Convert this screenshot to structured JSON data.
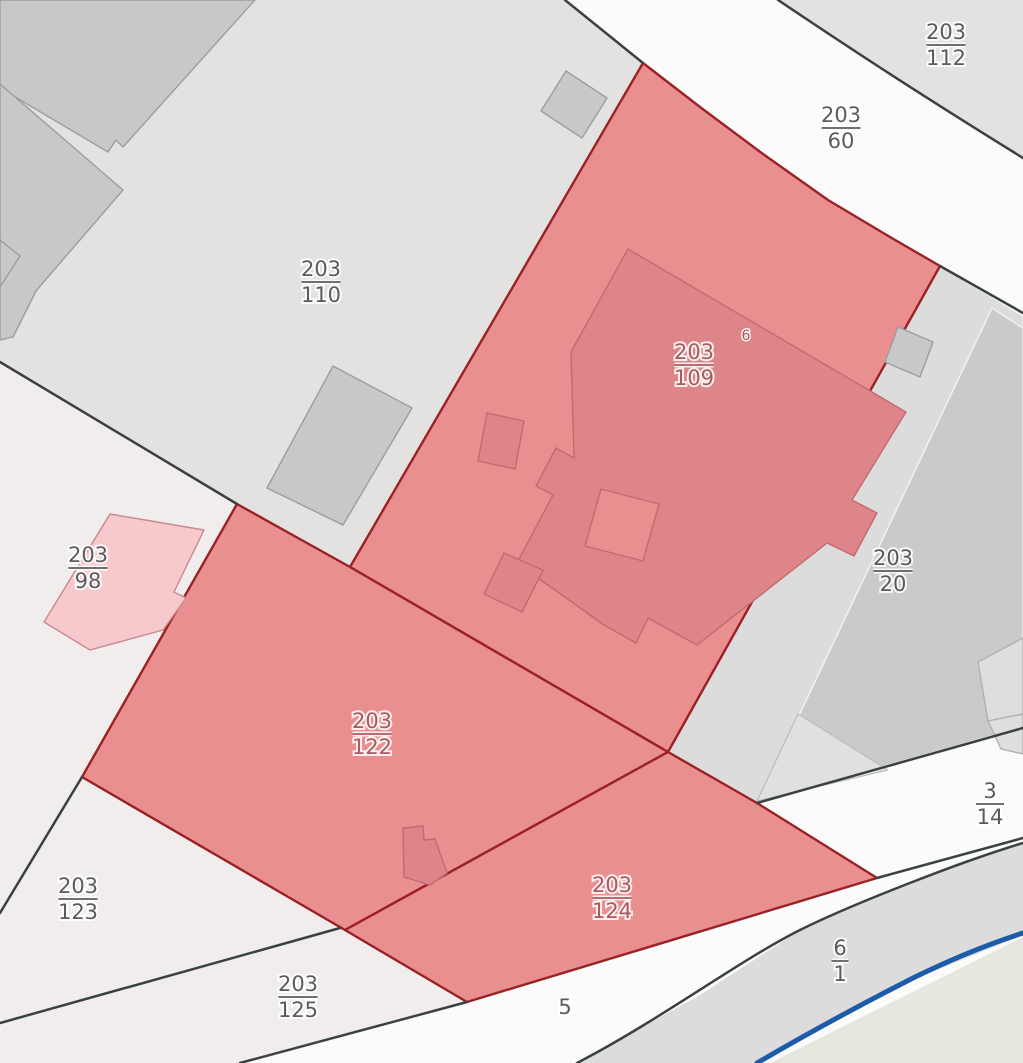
{
  "map": {
    "canvas": {
      "width": 1023,
      "height": 1063,
      "background": "#fbfbfb"
    },
    "palette": {
      "road_white": "#fbfbfb",
      "parcel_gray": "#e3e2e1",
      "parcel_pale": "#f1edec",
      "parcel_medium_gray": "#cacaca",
      "parcel_strip_gray": "#dddcdc",
      "parcel_back_gray": "#dcdcdc",
      "parcel_sage": "#e5e7de",
      "selection_red_fill": "#e98f8f",
      "selection_red_stroke": "#9b2126",
      "building_gray_fill": "#c8c8c8",
      "building_gray_stroke": "#9d9d9d",
      "building_red_fill": "#dd8588",
      "building_red_stroke": "#c26b6f",
      "building_pink_fill": "#f8c9cc",
      "building_pink_stroke": "#c9898e",
      "building_light_fill": "#dedede",
      "building_light_stroke": "#b0b0b0",
      "boundary_dark": "#3a4141",
      "stream_blue": "#1e5ca9",
      "label_gray": "#5b5b5b",
      "label_red": "#a85b60"
    },
    "regions": [
      {
        "id": "area-98",
        "points": "0,362 237,504 82,777 0,913",
        "fill": "#f1edec",
        "stroke": "none",
        "sw": 0,
        "interactable": true
      },
      {
        "id": "parcel-203-123",
        "points": "0,913 82,777 345,930 0,1023",
        "fill": "#f1edec",
        "stroke": "none",
        "sw": 0,
        "interactable": true
      },
      {
        "id": "parcel-203-125",
        "points": "0,1023 340,928 467,1002 240,1063 0,1063",
        "fill": "#f1edec",
        "stroke": "none",
        "sw": 0,
        "interactable": true
      },
      {
        "id": "parcel-203-110",
        "points": "0,0 565,0 643,63 350,567 237,504 0,362",
        "fill": "#e3e2e1",
        "stroke": "none",
        "sw": 0,
        "interactable": true
      },
      {
        "id": "parcel-203-112",
        "points": "778,0 1023,0 1023,158 940,106 845,45",
        "fill": "#e3e2e1",
        "stroke": "none",
        "sw": 0,
        "interactable": true
      },
      {
        "id": "road-shoulder-strip",
        "points": "940,266 1023,316 1023,342 770,799 757,803 668,752",
        "fill": "#dddcdc",
        "stroke": "#f4f4f4",
        "sw": 1.2,
        "interactable": false
      },
      {
        "id": "parcel-203-20",
        "points": "992,308 1023,328 1023,727 758,802",
        "fill": "#cacaca",
        "stroke": "#f1f1f1",
        "sw": 1.5,
        "interactable": true
      },
      {
        "id": "parcel-20-wedge",
        "points": "798,714 888,770 757,801",
        "fill": "#e0e0e0",
        "stroke": "#b7b7b7",
        "sw": 1,
        "interactable": false
      },
      {
        "id": "parcel-6-1",
        "points": "577,1063 700,995 800,930 877,895 960,862 1023,843 1023,935 900,985 800,1040 757,1063",
        "fill": "#dcdcdc",
        "stroke": "none",
        "sw": 0,
        "interactable": true
      },
      {
        "id": "area-sage",
        "points": "770,1063 1023,937 1023,1063",
        "fill": "#e5e7de",
        "stroke": "none",
        "sw": 0,
        "interactable": false
      },
      {
        "id": "parcel-203-109",
        "points": "643,63 700,107 763,154 828,200 890,237 940,266 668,752 350,567",
        "fill": "#e98f8f",
        "stroke": "#9b2126",
        "sw": 2.4,
        "interactable": true
      },
      {
        "id": "parcel-203-122",
        "points": "237,504 350,567 668,752 345,930 82,777",
        "fill": "#e98f8f",
        "stroke": "#9b2126",
        "sw": 2.4,
        "interactable": true
      },
      {
        "id": "parcel-203-124",
        "points": "668,752 757,803 877,878 467,1002 345,930",
        "fill": "#e98f8f",
        "stroke": "#9b2126",
        "sw": 2.4,
        "interactable": true
      }
    ],
    "buildings": [
      {
        "id": "building-gray-1",
        "points": "0,0 255,0 123,147 116,140 108,152 0,88",
        "kind": "gray"
      },
      {
        "id": "building-gray-2",
        "points": "0,84 123,190 48,277 36,291 13,337 0,340",
        "kind": "gray"
      },
      {
        "id": "building-gray-3",
        "points": "0,240 20,256 0,287",
        "kind": "gray"
      },
      {
        "id": "building-gray-4",
        "points": "333,366 412,408 343,525 267,488",
        "kind": "gray"
      },
      {
        "id": "building-gray-5",
        "points": "566,71 607,98 582,138 541,111",
        "kind": "gray"
      },
      {
        "id": "building-strip-square",
        "points": "898,327 933,342 920,377 885,362",
        "kind": "gray"
      },
      {
        "id": "building-pink-98",
        "points": "110,514 204,530 174,592 186,598 163,630 90,650 44,622",
        "kind": "pink"
      },
      {
        "id": "building-red-main",
        "points": "628,249 906,412 852,500 877,513 854,556 827,543 697,645 648,618 636,643 604,625 517,563 553,495 536,486 556,448 574,458 571,352",
        "kind": "red"
      },
      {
        "id": "building-red-courtyard",
        "points": "601,489 659,504 643,561 585,546",
        "kind": "courtyard"
      },
      {
        "id": "building-red-annex-west",
        "points": "487,413 524,421 515,469 478,461",
        "kind": "red"
      },
      {
        "id": "building-red-annex-south",
        "points": "504,553 543,570 522,612 484,594",
        "kind": "red"
      },
      {
        "id": "building-red-122",
        "points": "403,828 423,826 424,840 435,839 447,873 430,885 404,877",
        "kind": "red"
      },
      {
        "id": "building-light-20a",
        "points": "978,662 1023,638 1023,714 988,721",
        "kind": "light"
      },
      {
        "id": "building-light-20b",
        "points": "988,721 1023,714 1023,754 1001,749",
        "kind": "light"
      }
    ],
    "boundary_lines": [
      {
        "id": "road-edge-left",
        "d": "M565,0 L643,63"
      },
      {
        "id": "road-edge-upper",
        "d": "M778,0 C845,45 910,88 1023,158"
      },
      {
        "id": "road-edge-right",
        "d": "M940,266 L1023,313"
      },
      {
        "id": "line-110-98",
        "d": "M0,362 L237,504"
      },
      {
        "id": "line-98-123",
        "d": "M82,777 L0,913"
      },
      {
        "id": "line-123-125",
        "d": "M0,1023 L340,928"
      },
      {
        "id": "line-road5-west",
        "d": "M467,1002 L240,1063"
      },
      {
        "id": "line-20-south",
        "d": "M757,803 L1023,728"
      },
      {
        "id": "line-sliver",
        "d": "M877,878 L1023,838"
      },
      {
        "id": "line-6-1-north",
        "d": "M577,1063 C660,1020 740,960 800,930 C850,905 960,862 1023,843"
      }
    ],
    "stream": {
      "id": "stream-line",
      "d": "M757,1063 C810,1032 860,1005 915,977 C960,955 995,942 1023,933",
      "color": "#1e5ca9",
      "width": 5
    },
    "labels": [
      {
        "num": "203",
        "den": "112",
        "x": 946,
        "y": 45,
        "tone": "gray"
      },
      {
        "num": "203",
        "den": "60",
        "x": 841,
        "y": 128,
        "tone": "gray"
      },
      {
        "num": "203",
        "den": "110",
        "x": 321,
        "y": 282,
        "tone": "gray"
      },
      {
        "num": "203",
        "den": "109",
        "x": 694,
        "y": 365,
        "tone": "red"
      },
      {
        "num": "203",
        "den": "98",
        "x": 88,
        "y": 568,
        "tone": "gray"
      },
      {
        "num": "203",
        "den": "20",
        "x": 893,
        "y": 571,
        "tone": "gray"
      },
      {
        "num": "203",
        "den": "122",
        "x": 372,
        "y": 734,
        "tone": "red"
      },
      {
        "num": "3",
        "den": "14",
        "x": 990,
        "y": 804,
        "tone": "gray"
      },
      {
        "num": "203",
        "den": "123",
        "x": 78,
        "y": 899,
        "tone": "gray"
      },
      {
        "num": "203",
        "den": "124",
        "x": 612,
        "y": 898,
        "tone": "red"
      },
      {
        "num": "203",
        "den": "125",
        "x": 298,
        "y": 997,
        "tone": "gray"
      },
      {
        "num": "6",
        "den": "1",
        "x": 840,
        "y": 961,
        "tone": "gray"
      },
      {
        "num": "5",
        "den": null,
        "x": 565,
        "y": 1014,
        "tone": "gray"
      }
    ],
    "house_numbers": [
      {
        "text": "6",
        "x": 746,
        "y": 340,
        "tone": "red"
      }
    ]
  }
}
